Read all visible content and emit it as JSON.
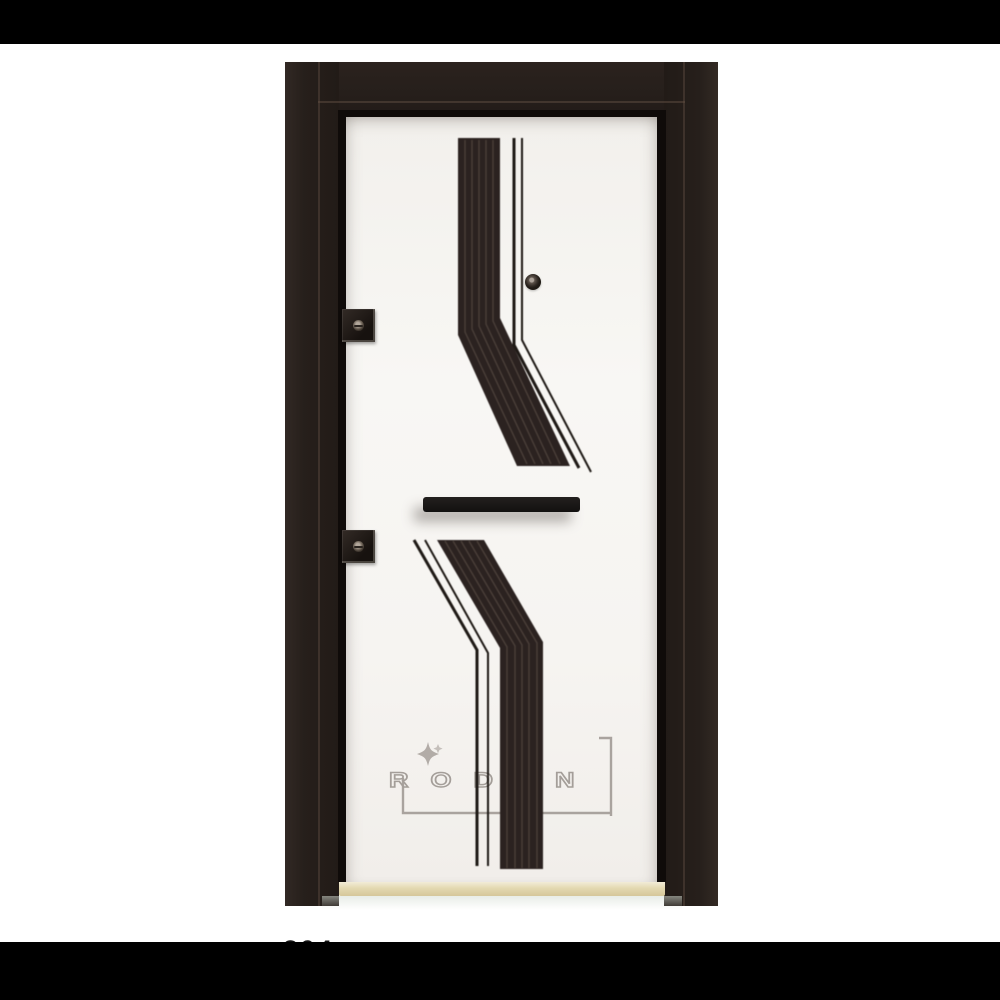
{
  "letterbox": {
    "color": "#000000"
  },
  "door": {
    "brand_logo": {
      "text": "RODEN",
      "color": "#a49e99",
      "sparkle_icon": "sparkle-icon"
    },
    "frame": {
      "color": "#261f1b"
    },
    "leaf": {
      "color": "#f6f4f1"
    },
    "ornament": {
      "band_color": "#2b2220",
      "ridge_color": "#564a41",
      "thin_line_color": "#1e1915"
    },
    "hardware": {
      "handle_color": "#161413",
      "hinge_count": 2,
      "hinge_color": "#1c1613",
      "peephole": true
    },
    "threshold": {
      "color": "#ddd2a9"
    }
  },
  "footer": {
    "product_code_partial": "304"
  }
}
